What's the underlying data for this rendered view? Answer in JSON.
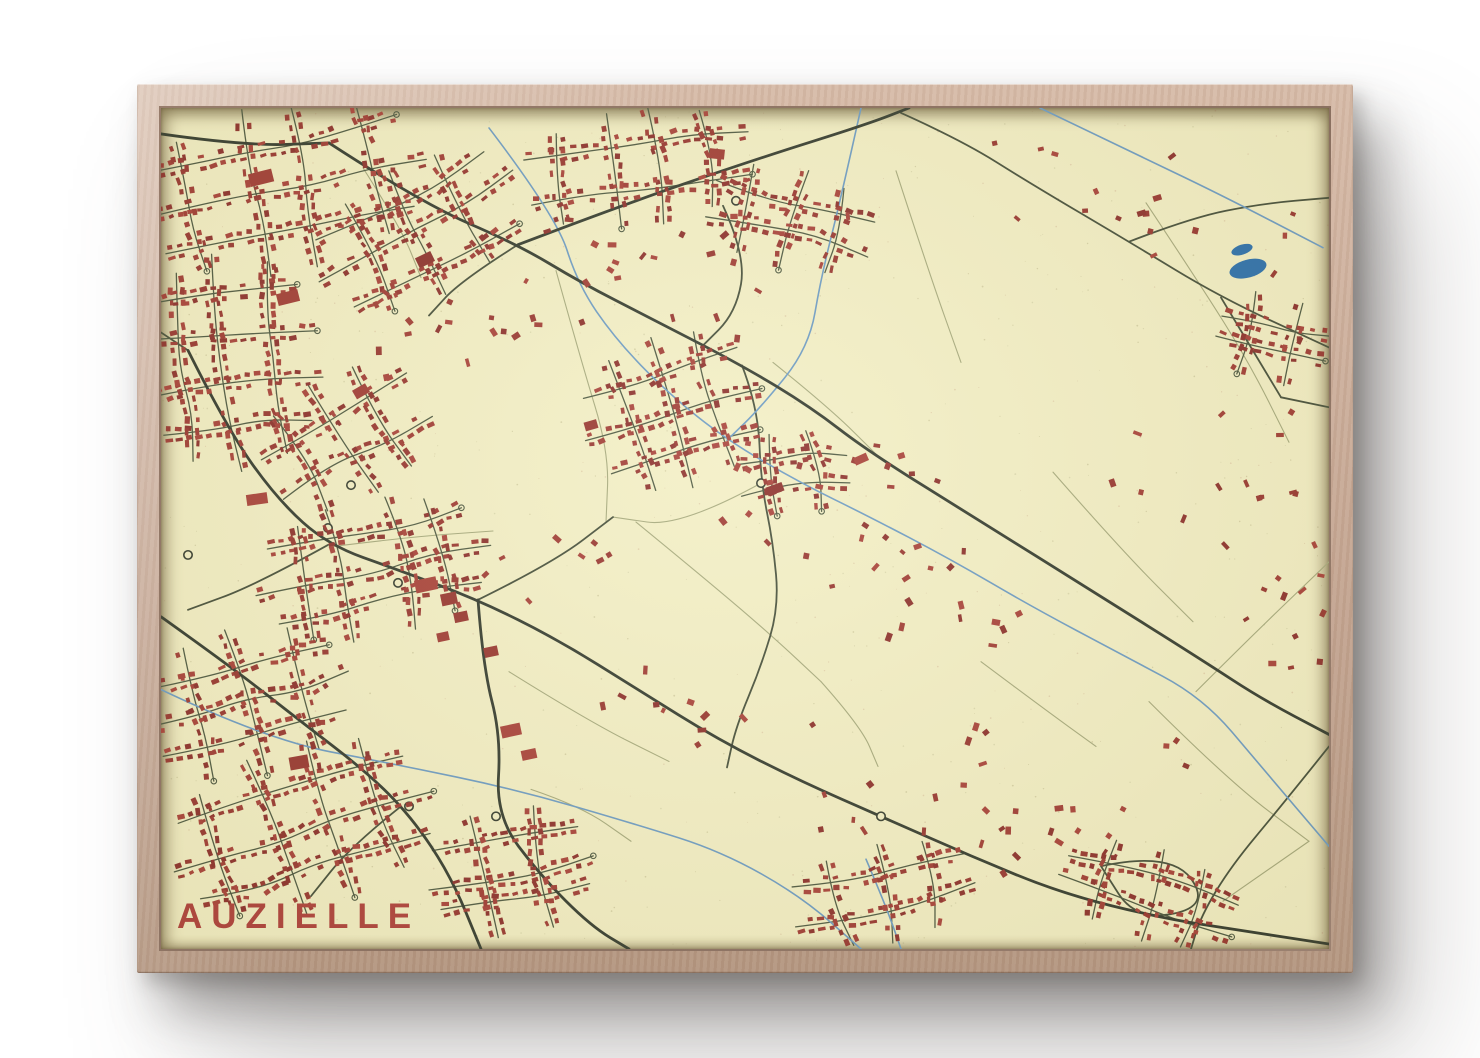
{
  "poster": {
    "title": "AUZIELLE"
  },
  "colors": {
    "wall": "#ffffff",
    "frame_light": "#d6baa7",
    "frame_mid": "#c4a591",
    "frame_dark": "#b3957f",
    "paper": "#f3efc5",
    "title": "#b0443e",
    "road_major": "#383f32",
    "road_secondary": "#49523d",
    "road_residential": "#515c44",
    "path_minor": "#a8ab7e",
    "water": "#6f9dc4",
    "water_fill": "#2f72ad",
    "buildings": [
      "#a23f37",
      "#9a3a33",
      "#aa453c",
      "#8f342f"
    ],
    "speckles": [
      "rgba(120,110,60,0.22)",
      "rgba(150,70,55,0.16)",
      "rgba(90,90,50,0.14)"
    ]
  },
  "map": {
    "viewbox": [
      0,
      0,
      1168,
      843
    ],
    "roads_major": [
      [
        [
          168,
          35
        ],
        [
          260,
          95
        ],
        [
          357,
          137
        ],
        [
          420,
          175
        ],
        [
          488,
          210
        ],
        [
          581,
          258
        ],
        [
          650,
          300
        ],
        [
          707,
          344
        ],
        [
          819,
          414
        ],
        [
          931,
          484
        ],
        [
          1042,
          554
        ],
        [
          1100,
          592
        ],
        [
          1168,
          628
        ]
      ],
      [
        [
          357,
          137
        ],
        [
          462,
          97
        ],
        [
          596,
          51
        ],
        [
          707,
          16
        ],
        [
          748,
          0
        ]
      ],
      [
        [
          0,
          26
        ],
        [
          84,
          38
        ],
        [
          168,
          35
        ]
      ],
      [
        [
          27,
          243
        ],
        [
          67,
          323
        ],
        [
          117,
          393
        ],
        [
          167,
          438
        ],
        [
          237,
          463
        ],
        [
          317,
          493
        ],
        [
          397,
          533
        ],
        [
          477,
          583
        ],
        [
          557,
          633
        ],
        [
          640,
          675
        ],
        [
          720,
          710
        ],
        [
          810,
          750
        ],
        [
          900,
          787
        ],
        [
          1000,
          812
        ],
        [
          1090,
          826
        ],
        [
          1168,
          838
        ]
      ],
      [
        [
          317,
          493
        ],
        [
          322,
          560
        ],
        [
          340,
          630
        ],
        [
          335,
          710
        ],
        [
          380,
          770
        ],
        [
          430,
          820
        ],
        [
          468,
          843
        ]
      ],
      [
        [
          0,
          510
        ],
        [
          70,
          560
        ],
        [
          140,
          615
        ],
        [
          205,
          665
        ],
        [
          250,
          710
        ],
        [
          290,
          770
        ],
        [
          320,
          843
        ]
      ]
    ],
    "roads_secondary": [
      [
        [
          357,
          137
        ],
        [
          300,
          173
        ],
        [
          268,
          208
        ]
      ],
      [
        [
          562,
          98
        ],
        [
          585,
          148
        ],
        [
          575,
          205
        ],
        [
          540,
          240
        ]
      ],
      [
        [
          317,
          493
        ],
        [
          392,
          456
        ],
        [
          452,
          410
        ]
      ],
      [
        [
          167,
          438
        ],
        [
          95,
          478
        ],
        [
          27,
          503
        ]
      ],
      [
        [
          581,
          258
        ],
        [
          597,
          300
        ],
        [
          600,
          376
        ],
        [
          612,
          435
        ],
        [
          618,
          500
        ],
        [
          600,
          560
        ],
        [
          575,
          620
        ],
        [
          566,
          661
        ]
      ],
      [
        [
          740,
          5
        ],
        [
          800,
          32
        ],
        [
          870,
          76
        ],
        [
          968,
          134
        ],
        [
          1060,
          190
        ],
        [
          1168,
          240
        ]
      ],
      [
        [
          968,
          134
        ],
        [
          1030,
          110
        ],
        [
          1100,
          96
        ],
        [
          1168,
          90
        ]
      ],
      [
        [
          1060,
          190
        ],
        [
          1090,
          240
        ],
        [
          1120,
          290
        ]
      ],
      [
        [
          1120,
          290
        ],
        [
          1168,
          300
        ]
      ],
      [
        [
          27,
          243
        ],
        [
          0,
          225
        ]
      ],
      [
        [
          240,
          700
        ],
        [
          190,
          740
        ],
        [
          150,
          790
        ]
      ],
      [
        [
          940,
          760
        ],
        [
          1010,
          745
        ],
        [
          1050,
          800
        ],
        [
          975,
          815
        ],
        [
          940,
          760
        ]
      ],
      [
        [
          1168,
          640
        ],
        [
          1120,
          700
        ],
        [
          1070,
          760
        ],
        [
          1040,
          810
        ],
        [
          1030,
          843
        ]
      ]
    ],
    "paths_minor": [
      [
        [
          395,
          163
        ],
        [
          420,
          253
        ],
        [
          448,
          345
        ],
        [
          445,
          415
        ]
      ],
      [
        [
          475,
          415
        ],
        [
          548,
          475
        ],
        [
          612,
          530
        ],
        [
          660,
          575
        ]
      ],
      [
        [
          735,
          63
        ],
        [
          768,
          165
        ],
        [
          800,
          255
        ]
      ],
      [
        [
          985,
          95
        ],
        [
          1038,
          175
        ],
        [
          1088,
          255
        ],
        [
          1128,
          335
        ]
      ],
      [
        [
          168,
          440
        ],
        [
          248,
          430
        ],
        [
          332,
          424
        ]
      ],
      [
        [
          988,
          595
        ],
        [
          1068,
          675
        ],
        [
          1148,
          735
        ]
      ],
      [
        [
          1148,
          735
        ],
        [
          1062,
          795
        ]
      ],
      [
        [
          892,
          365
        ],
        [
          962,
          445
        ],
        [
          1032,
          515
        ]
      ],
      [
        [
          348,
          565
        ],
        [
          428,
          615
        ],
        [
          508,
          655
        ]
      ],
      [
        [
          612,
          255
        ],
        [
          668,
          300
        ],
        [
          720,
          352
        ]
      ],
      [
        [
          820,
          555
        ],
        [
          880,
          600
        ],
        [
          935,
          640
        ]
      ],
      [
        [
          1035,
          585
        ],
        [
          1095,
          525
        ],
        [
          1168,
          455
        ]
      ],
      [
        [
          600,
          376
        ],
        [
          520,
          420
        ],
        [
          452,
          410
        ]
      ],
      [
        [
          660,
          575
        ],
        [
          700,
          620
        ],
        [
          717,
          660
        ]
      ],
      [
        [
          202,
          60
        ],
        [
          240,
          120
        ],
        [
          260,
          170
        ]
      ],
      [
        [
          370,
          683
        ],
        [
          420,
          700
        ],
        [
          470,
          735
        ]
      ]
    ],
    "streams": [
      [
        [
          328,
          20
        ],
        [
          395,
          108
        ],
        [
          417,
          177
        ],
        [
          454,
          231
        ],
        [
          506,
          285
        ],
        [
          566,
          333
        ],
        [
          640,
          376
        ],
        [
          707,
          409
        ],
        [
          789,
          452
        ],
        [
          871,
          500
        ],
        [
          961,
          548
        ],
        [
          1042,
          591
        ],
        [
          1100,
          660
        ],
        [
          1168,
          740
        ]
      ],
      [
        [
          0,
          583
        ],
        [
          105,
          633
        ],
        [
          235,
          658
        ],
        [
          355,
          683
        ],
        [
          475,
          718
        ],
        [
          560,
          745
        ],
        [
          640,
          790
        ],
        [
          700,
          843
        ]
      ],
      [
        [
          879,
          0
        ],
        [
          968,
          43
        ],
        [
          1058,
          86
        ],
        [
          1162,
          140
        ]
      ],
      [
        [
          700,
          0
        ],
        [
          680,
          90
        ],
        [
          660,
          170
        ],
        [
          648,
          240
        ],
        [
          600,
          300
        ],
        [
          566,
          333
        ]
      ],
      [
        [
          705,
          753
        ],
        [
          725,
          800
        ],
        [
          740,
          843
        ]
      ]
    ],
    "lake": [
      {
        "cx": 1081,
        "cy": 142,
        "rx": 11,
        "ry": 5,
        "rot": -18
      },
      {
        "cx": 1087,
        "cy": 161,
        "rx": 19,
        "ry": 9,
        "rot": -15
      }
    ],
    "clusters": [
      {
        "cx": 120,
        "cy": 80,
        "rx": 148,
        "ry": 86,
        "rot": -12,
        "seed": 11
      },
      {
        "cx": 258,
        "cy": 124,
        "rx": 112,
        "ry": 68,
        "rot": -28,
        "seed": 12
      },
      {
        "cx": 70,
        "cy": 255,
        "rx": 92,
        "ry": 110,
        "rot": -6,
        "seed": 13
      },
      {
        "cx": 185,
        "cy": 330,
        "rx": 90,
        "ry": 64,
        "rot": -30,
        "seed": 14
      },
      {
        "cx": 478,
        "cy": 60,
        "rx": 122,
        "ry": 60,
        "rot": -8,
        "seed": 15
      },
      {
        "cx": 630,
        "cy": 112,
        "rx": 86,
        "ry": 52,
        "rot": 14,
        "seed": 16
      },
      {
        "cx": 512,
        "cy": 305,
        "rx": 92,
        "ry": 78,
        "rot": -18,
        "seed": 17
      },
      {
        "cx": 633,
        "cy": 366,
        "rx": 58,
        "ry": 44,
        "rot": -6,
        "seed": 18
      },
      {
        "cx": 212,
        "cy": 462,
        "rx": 120,
        "ry": 70,
        "rot": -12,
        "seed": 19
      },
      {
        "cx": 86,
        "cy": 596,
        "rx": 106,
        "ry": 76,
        "rot": -14,
        "seed": 20
      },
      {
        "cx": 142,
        "cy": 722,
        "rx": 136,
        "ry": 84,
        "rot": -18,
        "seed": 21
      },
      {
        "cx": 350,
        "cy": 766,
        "rx": 84,
        "ry": 66,
        "rot": -10,
        "seed": 22
      },
      {
        "cx": 722,
        "cy": 788,
        "rx": 96,
        "ry": 50,
        "rot": -12,
        "seed": 23
      },
      {
        "cx": 988,
        "cy": 788,
        "rx": 95,
        "ry": 47,
        "rot": 18,
        "seed": 24
      },
      {
        "cx": 1112,
        "cy": 232,
        "rx": 58,
        "ry": 46,
        "rot": 14,
        "seed": 25
      }
    ],
    "scatter": [
      {
        "x": 310,
        "y": 85,
        "w": 300,
        "h": 150,
        "n": 26,
        "seed": 31
      },
      {
        "x": 560,
        "y": 330,
        "w": 220,
        "h": 150,
        "n": 22,
        "seed": 32
      },
      {
        "x": 700,
        "y": 430,
        "w": 180,
        "h": 110,
        "n": 13,
        "seed": 33
      },
      {
        "x": 830,
        "y": 20,
        "w": 210,
        "h": 110,
        "n": 10,
        "seed": 34
      },
      {
        "x": 950,
        "y": 300,
        "w": 190,
        "h": 150,
        "n": 9,
        "seed": 35
      },
      {
        "x": 640,
        "y": 600,
        "w": 210,
        "h": 130,
        "n": 14,
        "seed": 36
      },
      {
        "x": 860,
        "y": 620,
        "w": 170,
        "h": 110,
        "n": 8,
        "seed": 37
      },
      {
        "x": 400,
        "y": 545,
        "w": 190,
        "h": 110,
        "n": 10,
        "seed": 38
      },
      {
        "x": 980,
        "y": 80,
        "w": 170,
        "h": 90,
        "n": 7,
        "seed": 39
      },
      {
        "x": 1080,
        "y": 350,
        "w": 85,
        "h": 220,
        "n": 10,
        "seed": 40
      },
      {
        "x": 320,
        "y": 408,
        "w": 140,
        "h": 90,
        "n": 8,
        "seed": 41
      },
      {
        "x": 820,
        "y": 700,
        "w": 130,
        "h": 80,
        "n": 8,
        "seed": 42
      },
      {
        "x": 1060,
        "y": 430,
        "w": 100,
        "h": 140,
        "n": 7,
        "seed": 43
      },
      {
        "x": 180,
        "y": 180,
        "w": 130,
        "h": 90,
        "n": 10,
        "seed": 44
      }
    ],
    "large_buildings": [
      [
        100,
        70,
        24,
        13,
        -14
      ],
      [
        127,
        190,
        22,
        12,
        -14
      ],
      [
        264,
        152,
        17,
        11,
        -26
      ],
      [
        96,
        392,
        21,
        11,
        -8
      ],
      [
        265,
        478,
        22,
        13,
        -12
      ],
      [
        288,
        492,
        16,
        12,
        -12
      ],
      [
        300,
        510,
        14,
        10,
        -12
      ],
      [
        282,
        530,
        12,
        9,
        -12
      ],
      [
        350,
        624,
        20,
        12,
        -12
      ],
      [
        368,
        648,
        15,
        10,
        -12
      ],
      [
        138,
        656,
        19,
        13,
        -10
      ],
      [
        556,
        46,
        15,
        10,
        6
      ],
      [
        614,
        382,
        17,
        9,
        -20
      ],
      [
        700,
        352,
        14,
        8,
        -24
      ],
      [
        200,
        284,
        15,
        10,
        -30
      ],
      [
        430,
        318,
        13,
        9,
        -16
      ],
      [
        330,
        545,
        14,
        10,
        -12
      ]
    ],
    "nodes": [
      [
        237,
        476
      ],
      [
        167,
        421
      ],
      [
        190,
        378
      ],
      [
        27,
        448
      ],
      [
        575,
        93
      ],
      [
        720,
        710
      ],
      [
        335,
        710
      ],
      [
        248,
        700
      ],
      [
        600,
        376
      ]
    ],
    "speckles": {
      "count": 620,
      "seed": 91
    }
  }
}
